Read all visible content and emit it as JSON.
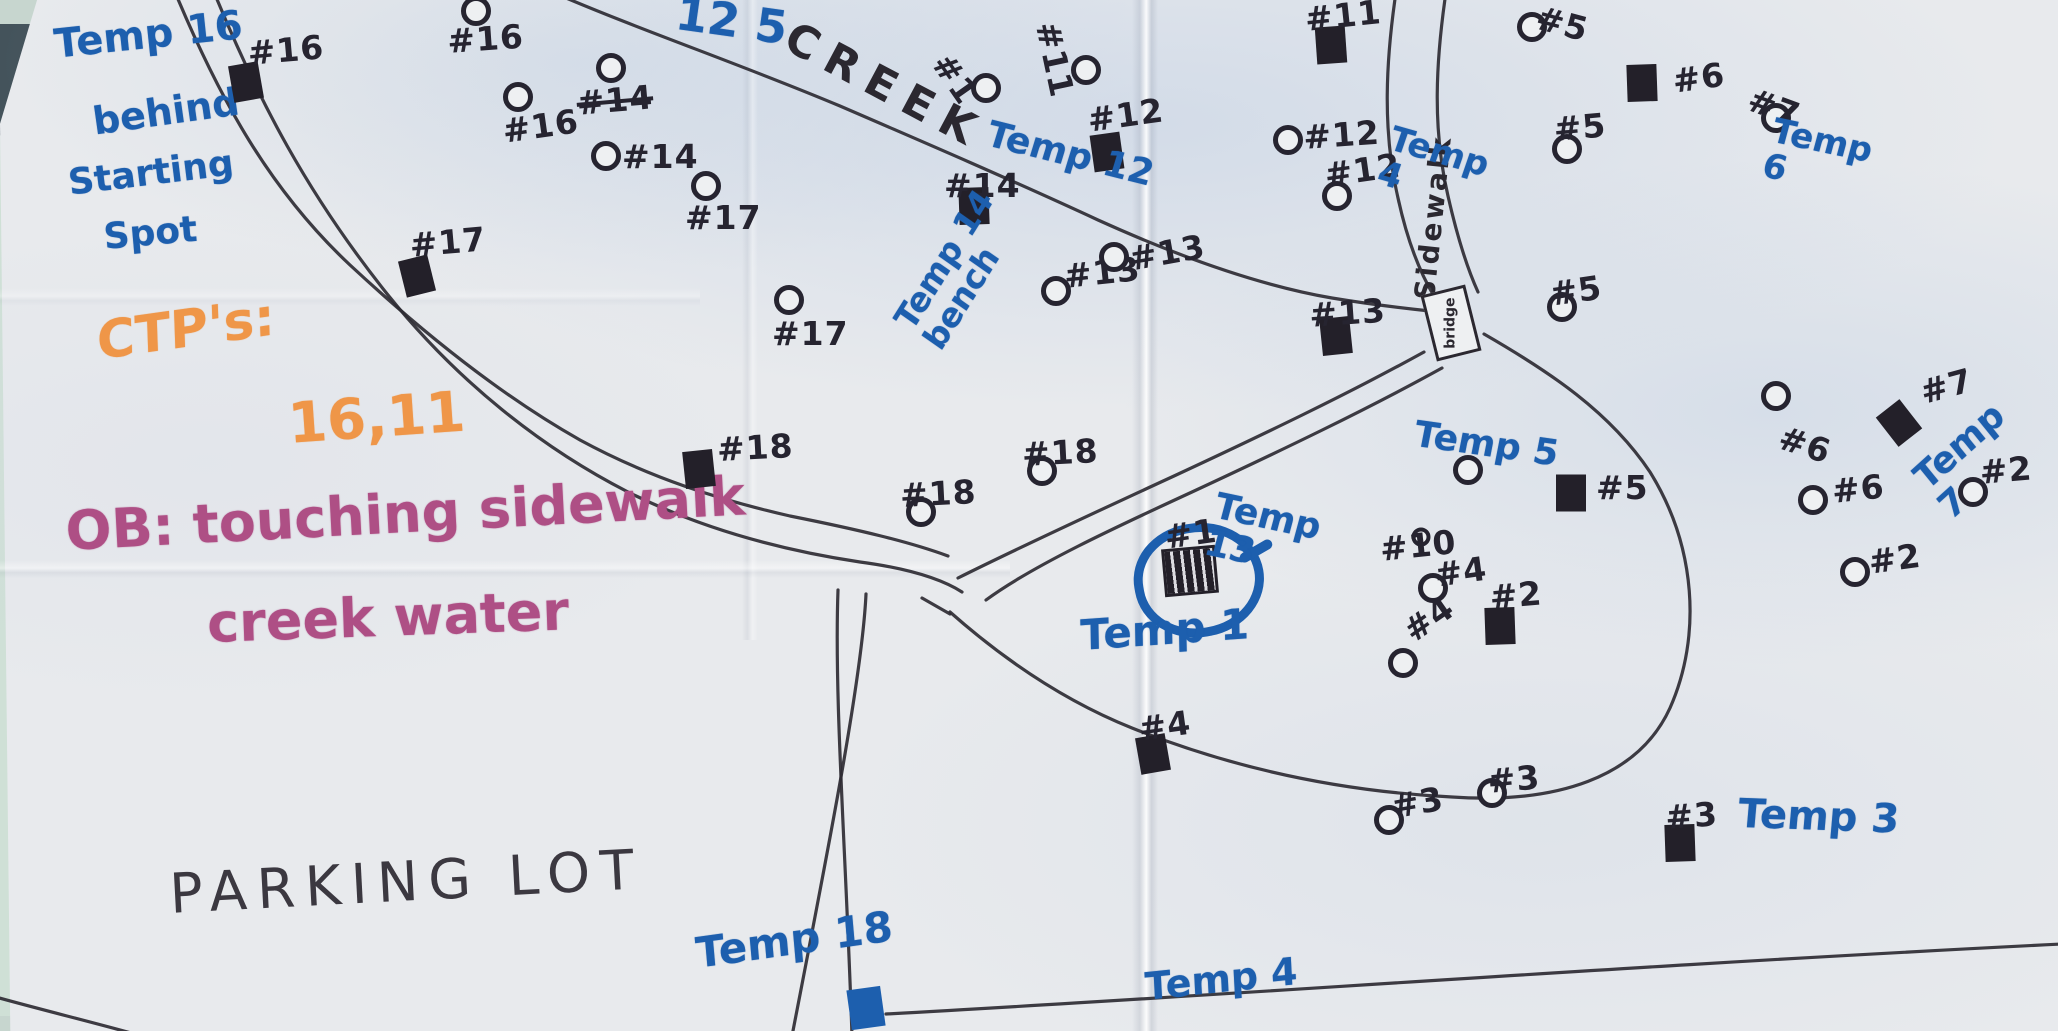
{
  "title": "Hand-drawn disc golf course map (photo of paper)",
  "colors": {
    "ink": "#2b2830",
    "blue": "#1d5fae",
    "orange": "#ef9648",
    "purple": "#ae4f85",
    "pencil": "#3b3840",
    "paper": "#e8eaed"
  },
  "notes": {
    "temp16": [
      "Temp 16",
      "behind",
      "Starting",
      "Spot"
    ],
    "ctp_heading": "CTP's:",
    "ctp_values": "16,11",
    "ob_line1": "OB: touching sidewalk",
    "ob_line2": "creek water",
    "parking_lot": "PARKING LOT",
    "creek": "CREEK",
    "sidewalk": "Sidewalk",
    "bridge": "bridge",
    "edge_scribble": "12 5",
    "circled_hole_label": "#1"
  },
  "temp_labels": [
    {
      "text": "Temp 12",
      "x": 993,
      "y": 116,
      "rot": 14,
      "size": 36
    },
    {
      "text": "Temp 14 bench",
      "x": 889,
      "y": 316,
      "rot": -58,
      "size": 33,
      "w": 175
    },
    {
      "text": "Temp 4",
      "x": 1396,
      "y": 122,
      "rot": 16,
      "size": 34,
      "w": 95
    },
    {
      "text": "Temp 6",
      "x": 1777,
      "y": 114,
      "rot": 12,
      "size": 34,
      "w": 98
    },
    {
      "text": "Temp 7",
      "x": 1908,
      "y": 468,
      "rot": -42,
      "size": 36,
      "w": 108
    },
    {
      "text": "Temp 5",
      "x": 1418,
      "y": 416,
      "rot": 8,
      "size": 36
    },
    {
      "text": "Temp 13",
      "x": 1220,
      "y": 488,
      "rot": 12,
      "size": 36,
      "w": 115
    },
    {
      "text": "Temp 1",
      "x": 1080,
      "y": 614,
      "rot": -4,
      "size": 42
    },
    {
      "text": "Temp 3",
      "x": 1740,
      "y": 793,
      "rot": 2,
      "size": 40
    },
    {
      "text": "Temp 18",
      "x": 694,
      "y": 932,
      "rot": -8,
      "size": 42
    },
    {
      "text": "Temp 4",
      "x": 1144,
      "y": 968,
      "rot": -6,
      "size": 38
    }
  ],
  "markers": [
    {
      "t": "tee",
      "x": 246,
      "y": 82,
      "rot": -10,
      "l": "#16",
      "lx": 246,
      "ly": 34,
      "lr": -5
    },
    {
      "t": "tee",
      "x": 417,
      "y": 276,
      "rot": -14,
      "l": "#17",
      "lx": 408,
      "ly": 226,
      "lr": -5
    },
    {
      "t": "tee",
      "x": 699,
      "y": 469,
      "rot": -6,
      "l": "#18",
      "lx": 716,
      "ly": 430,
      "lr": -3
    },
    {
      "t": "tee",
      "x": 974,
      "y": 206,
      "rot": -2,
      "l": "#14",
      "lx": 944,
      "ly": 166,
      "lr": 0
    },
    {
      "t": "tee",
      "x": 1107,
      "y": 152,
      "rot": -8,
      "l": "#12",
      "lx": 1085,
      "ly": 101,
      "lr": -8
    },
    {
      "t": "tee",
      "x": 1331,
      "y": 45,
      "rot": -4,
      "l": "#11",
      "lx": 1303,
      "ly": 0,
      "lr": -6
    },
    {
      "t": "tee",
      "x": 1336,
      "y": 336,
      "rot": -6,
      "l": "#13",
      "lx": 1308,
      "ly": 296,
      "lr": -4
    },
    {
      "t": "tee",
      "x": 1571,
      "y": 493,
      "rot": 0,
      "l": "#5",
      "lx": 1596,
      "ly": 468,
      "lr": 0
    },
    {
      "t": "tee",
      "x": 1642,
      "y": 83,
      "rot": -2,
      "l": "#6",
      "lx": 1670,
      "ly": 62,
      "lr": -8
    },
    {
      "t": "tee",
      "x": 1899,
      "y": 423,
      "rot": -38,
      "l": "#7",
      "lx": 1916,
      "ly": 374,
      "lr": -15
    },
    {
      "t": "tee",
      "x": 1500,
      "y": 626,
      "rot": -2,
      "l": "#2",
      "lx": 1488,
      "ly": 578,
      "lr": -5
    },
    {
      "t": "tee",
      "x": 1153,
      "y": 754,
      "rot": -10,
      "l": "#4",
      "lx": 1136,
      "ly": 710,
      "lr": -8
    },
    {
      "t": "tee",
      "x": 1680,
      "y": 843,
      "rot": -2,
      "l": "#3",
      "lx": 1664,
      "ly": 798,
      "lr": -4
    },
    {
      "t": "teeb",
      "x": 866,
      "y": 1008,
      "rot": -8
    },
    {
      "t": "hatch",
      "x": 1190,
      "y": 571,
      "rot": -5,
      "l": "#1",
      "lx": 1162,
      "ly": 518,
      "lr": -8
    },
    {
      "t": "bk",
      "x": 476,
      "y": 11,
      "l": "#16",
      "lx": 446,
      "ly": 22,
      "lr": -4
    },
    {
      "t": "bk",
      "x": 518,
      "y": 97,
      "l": "#16",
      "lx": 500,
      "ly": 112,
      "lr": -8
    },
    {
      "t": "bk",
      "x": 611,
      "y": 68,
      "l": "#14",
      "lx": 575,
      "ly": 84,
      "lr": -5,
      "strike": true
    },
    {
      "t": "bk",
      "x": 606,
      "y": 156,
      "l": "#14",
      "lx": 622,
      "ly": 137,
      "lr": 0
    },
    {
      "t": "bk",
      "x": 706,
      "y": 186,
      "l": "#17",
      "lx": 685,
      "ly": 198,
      "lr": 0
    },
    {
      "t": "bk",
      "x": 789,
      "y": 300,
      "l": "#17",
      "lx": 772,
      "ly": 314,
      "lr": 0
    },
    {
      "t": "bk",
      "x": 921,
      "y": 512,
      "l": "#18",
      "lx": 899,
      "ly": 476,
      "lr": -3
    },
    {
      "t": "bk",
      "x": 1042,
      "y": 471,
      "l": "#18",
      "lx": 1021,
      "ly": 435,
      "lr": -3
    },
    {
      "t": "bk",
      "x": 1056,
      "y": 291,
      "l": "#13",
      "lx": 1062,
      "ly": 257,
      "lr": -6
    },
    {
      "t": "bk",
      "x": 1114,
      "y": 257,
      "l": "#13",
      "lx": 1126,
      "ly": 240,
      "lr": -10
    },
    {
      "t": "bk",
      "x": 1086,
      "y": 70,
      "l": "#11",
      "lx": 1066,
      "ly": 18,
      "lr": 78
    },
    {
      "t": "bk",
      "x": 986,
      "y": 88,
      "l": "#1",
      "lx": 956,
      "ly": 46,
      "lr": 55
    },
    {
      "t": "bk",
      "x": 1288,
      "y": 140,
      "l": "#12",
      "lx": 1302,
      "ly": 118,
      "lr": -4
    },
    {
      "t": "bk",
      "x": 1337,
      "y": 196,
      "l": "#12",
      "lx": 1322,
      "ly": 156,
      "lr": -8
    },
    {
      "t": "bk",
      "x": 1532,
      "y": 27,
      "l": "#5",
      "lx": 1542,
      "ly": -2,
      "lr": 15
    },
    {
      "t": "bk",
      "x": 1567,
      "y": 149,
      "l": "#5",
      "lx": 1552,
      "ly": 110,
      "lr": -5
    },
    {
      "t": "bk",
      "x": 1562,
      "y": 307,
      "l": "#5",
      "lx": 1547,
      "ly": 275,
      "lr": -8
    },
    {
      "t": "bk",
      "x": 1776,
      "y": 118,
      "l": "#7",
      "lx": 1756,
      "ly": 80,
      "lr": 20
    },
    {
      "t": "bk",
      "x": 1776,
      "y": 396,
      "l": "#6",
      "lx": 1786,
      "ly": 418,
      "lr": 18
    },
    {
      "t": "bk",
      "x": 1813,
      "y": 500,
      "l": "#6",
      "lx": 1830,
      "ly": 472,
      "lr": -6
    },
    {
      "t": "bk",
      "x": 1973,
      "y": 492,
      "l": "#2",
      "lx": 1978,
      "ly": 453,
      "lr": -5
    },
    {
      "t": "bk",
      "x": 1855,
      "y": 572,
      "l": "#2",
      "lx": 1866,
      "ly": 543,
      "lr": -8
    },
    {
      "t": "bks",
      "x": 1421,
      "y": 537,
      "l": "#10",
      "lx": 1378,
      "ly": 530,
      "lr": -6
    },
    {
      "t": "bk",
      "x": 1433,
      "y": 588,
      "l": "#4",
      "lx": 1432,
      "ly": 556,
      "lr": -8
    },
    {
      "t": "bk",
      "x": 1403,
      "y": 663,
      "l": "#4",
      "lx": 1396,
      "ly": 618,
      "lr": -35
    },
    {
      "t": "bk",
      "x": 1389,
      "y": 820,
      "l": "#3",
      "lx": 1388,
      "ly": 788,
      "lr": -10
    },
    {
      "t": "bk",
      "x": 1492,
      "y": 793,
      "l": "#3",
      "lx": 1486,
      "ly": 762,
      "lr": -5
    },
    {
      "t": "bk",
      "x": 1468,
      "y": 470
    }
  ]
}
